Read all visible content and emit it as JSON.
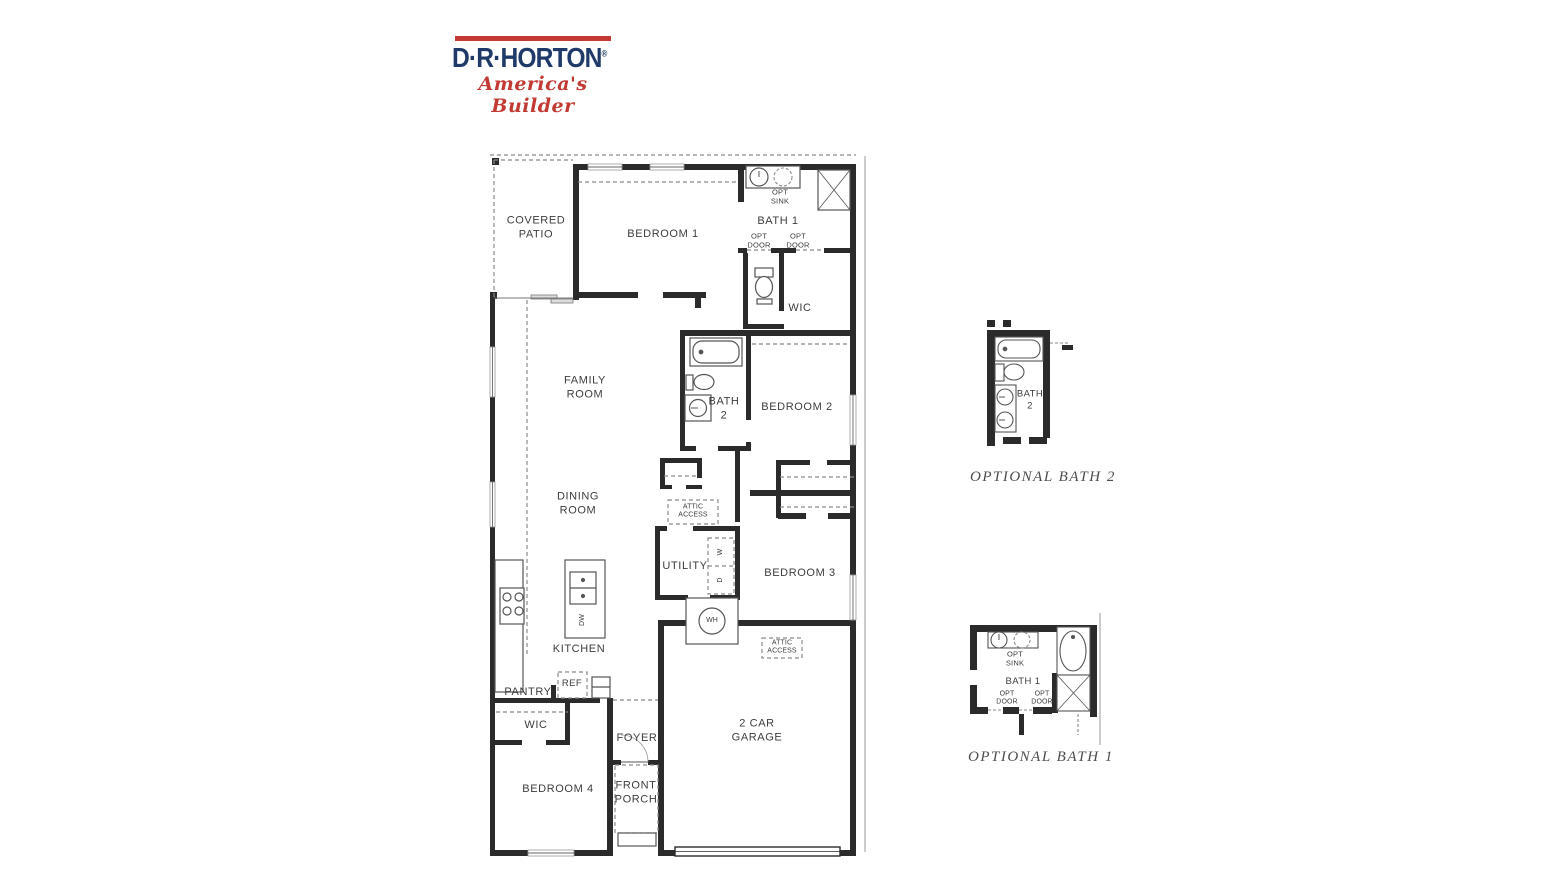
{
  "logo": {
    "brand": "D·R·HORTON",
    "registered": "®",
    "tagline": "America's Builder",
    "navy": "#1f3a69",
    "red": "#c23a33"
  },
  "plan": {
    "rooms": {
      "covered_patio": "COVERED\nPATIO",
      "bedroom1": "BEDROOM 1",
      "bath1": "BATH 1",
      "opt_sink": "OPT\nSINK",
      "opt_door": "OPT\nDOOR",
      "wic": "WIC",
      "family_room": "FAMILY\nROOM",
      "bath2": "BATH\n2",
      "bedroom2": "BEDROOM 2",
      "dining_room": "DINING\nROOM",
      "attic_access": "ATTIC\nACCESS",
      "utility": "UTILITY",
      "bedroom3": "BEDROOM 3",
      "wh": "WH",
      "washer": "W",
      "dryer": "D",
      "dw": "DW",
      "kitchen": "KITCHEN",
      "pantry": "PANTRY",
      "ref": "REF",
      "foyer": "FOYER",
      "bedroom4": "BEDROOM 4",
      "front_porch": "FRONT\nPORCH",
      "garage": "2 CAR\nGARAGE"
    }
  },
  "insets": {
    "bath2": {
      "label": "BATH\n2",
      "caption": "OPTIONAL BATH 2"
    },
    "bath1": {
      "label": "BATH 1",
      "opt_sink": "OPT\nSINK",
      "opt_door": "OPT\nDOOR",
      "caption": "OPTIONAL BATH 1"
    }
  },
  "colors": {
    "wall": "#2b2b2b",
    "label": "#3d3d3d",
    "dashed": "#8a8a8a"
  }
}
